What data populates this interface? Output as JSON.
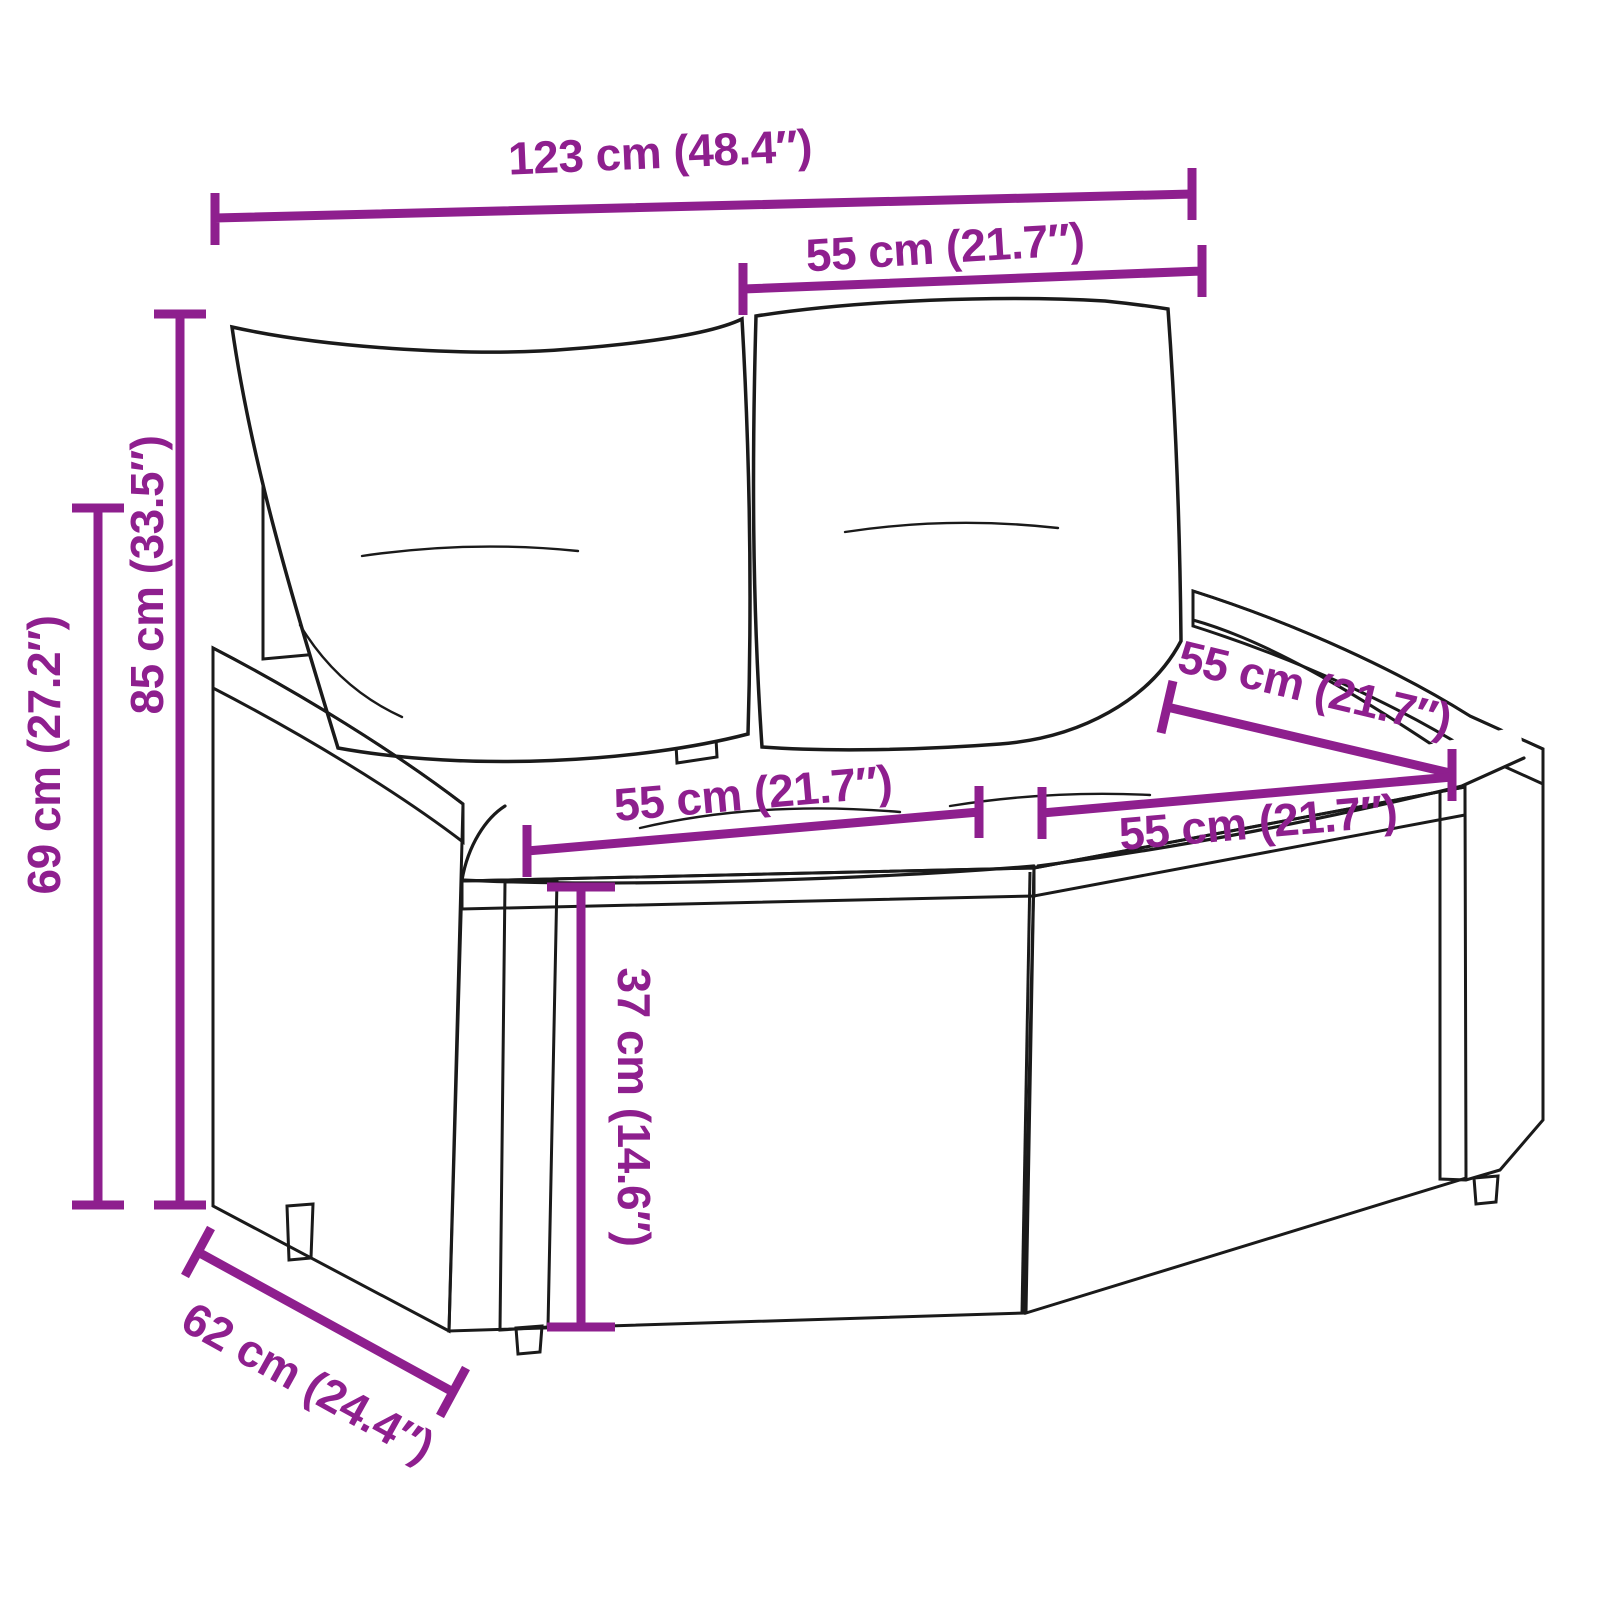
{
  "diagram": {
    "description": "Dimension diagram of a poly rattan 2-seater garden sofa with back and seat cushions",
    "accent_color": "#8E1F8E",
    "outline_color": "#1a1a1a",
    "background_color": "#ffffff",
    "dimensions": {
      "overall_width": "123 cm (48.4″)",
      "backrest_width": "55 cm (21.7″)",
      "total_height": "85 cm (33.5″)",
      "armrest_height": "69 cm (27.2″)",
      "seat_depth": "55 cm (21.7″)",
      "seat_width_left": "55 cm (21.7″)",
      "seat_width_right": "55 cm (21.7″)",
      "seat_height": "37 cm (14.6″)",
      "overall_depth": "62 cm (24.4″)"
    }
  }
}
